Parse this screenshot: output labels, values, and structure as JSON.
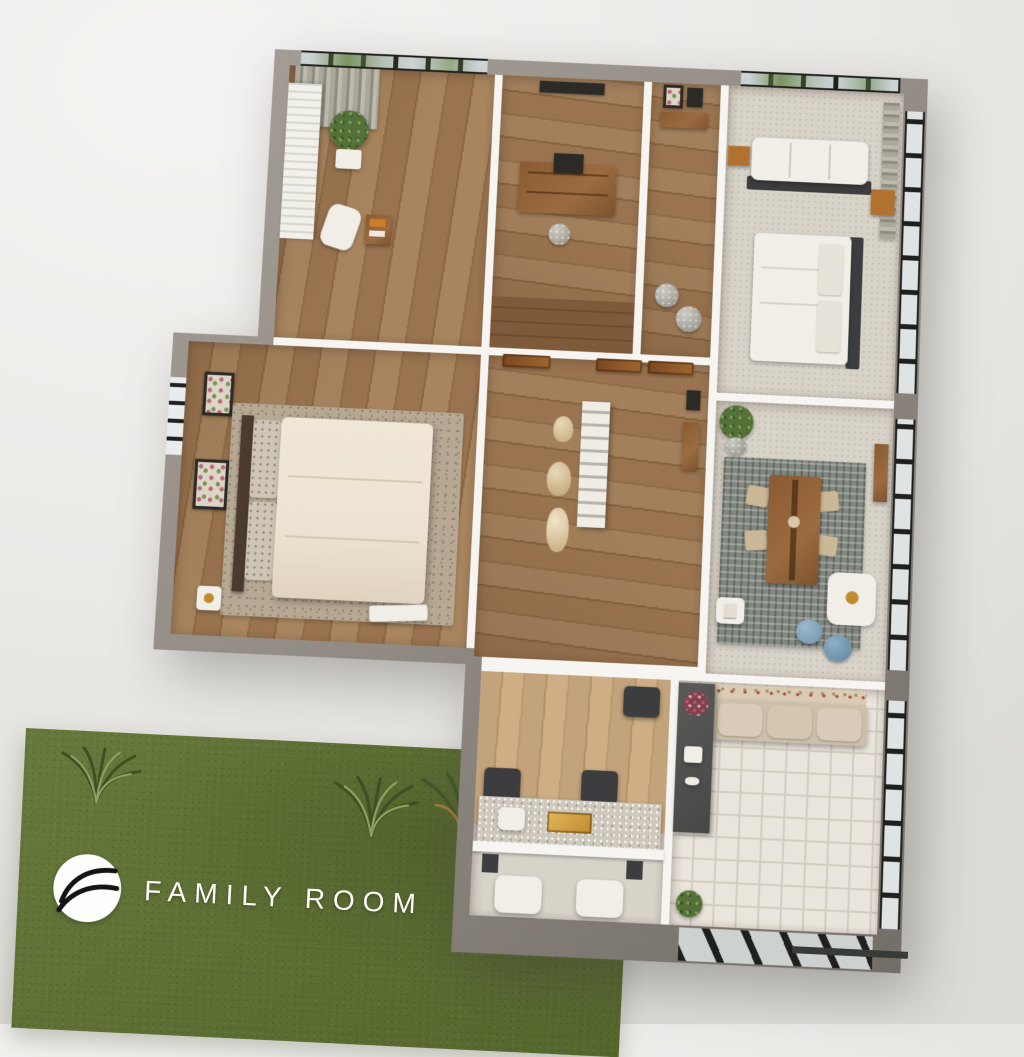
{
  "branding": {
    "label": "FAMILY ROOM",
    "logo_icon": "wave-circle-logo"
  },
  "scene": {
    "type": "3d-floorplan-render",
    "rooms": [
      {
        "id": "study",
        "floor": "wood",
        "items": [
          "curtain",
          "window-blinds",
          "potted-plant",
          "office-chair",
          "side-table"
        ]
      },
      {
        "id": "home-office",
        "floor": "wood",
        "items": [
          "art-frame",
          "wooden-desk",
          "stool",
          "steps"
        ]
      },
      {
        "id": "entry",
        "floor": "wood",
        "items": [
          "console-table",
          "picture-frames",
          "poufs"
        ]
      },
      {
        "id": "bedroom",
        "floor": "tile",
        "items": [
          "white-sofa",
          "nightstands",
          "bed",
          "curtain",
          "corner-windows"
        ]
      },
      {
        "id": "master-bedroom",
        "floor": "wood",
        "items": [
          "speckled-rug",
          "bed",
          "patterned-pillows",
          "art-frames",
          "nightstand",
          "bench"
        ]
      },
      {
        "id": "hallway",
        "floor": "wood",
        "items": [
          "wooden-doors",
          "ladder-shelf",
          "vases"
        ]
      },
      {
        "id": "dining-area",
        "floor": "tile",
        "items": [
          "mosaic-rug",
          "dining-table",
          "chairs",
          "white-armchair",
          "blue-poufs",
          "potted-plant",
          "side-table"
        ]
      },
      {
        "id": "media-room",
        "floor": "wood-light",
        "items": [
          "dark-ottomans",
          "sparkle-console",
          "speakers",
          "white-armchairs"
        ]
      },
      {
        "id": "lounge",
        "floor": "white-tile",
        "items": [
          "beige-sofa",
          "shelf-unit",
          "flower-arrangement",
          "coffee-machine",
          "potted-plant",
          "corner-windows"
        ]
      },
      {
        "id": "front-lawn",
        "floor": "grass",
        "items": [
          "grass-tufts",
          "brand-logo",
          "brand-label"
        ]
      }
    ]
  },
  "colors": {
    "background": "#eceae7",
    "ground": "#dcdbd7",
    "wall_outer": "#938d86",
    "wall_outer_dark": "#736e67",
    "wall_inner": "#f7f5f1",
    "floor_wood": "#9a7450",
    "floor_wood_light": "#c3a37b",
    "floor_tile": "#d8d3c9",
    "floor_tile_white": "#eae5dc",
    "grout": "#d3ccc0",
    "rug_mosaic": "#82877f",
    "rug_speckle": "#b6a893",
    "window_frame": "#1f1f1d",
    "glass": "#ccd3d5",
    "glass_frost": "#dfe3e4",
    "tree_green": "#5f7f3c",
    "curtain": "#aaa79b",
    "door_wood": "#8a5426",
    "furn_wood": "#9c6b3f",
    "furn_wood_orange": "#b0722e",
    "linen": "#ece3d2",
    "pillow": "#cfc5b4",
    "sofa": "#cdc0ab",
    "white_furn": "#f1eee8",
    "ottoman": "#3d3d3f",
    "accent_blue": "#6f93ad",
    "accent_gold": "#c08a2e",
    "plant": "#55713a",
    "grass": "#67793c",
    "grass_dark": "#55662e",
    "logo_ink": "#141414",
    "text_white": "#fbfaf7"
  }
}
